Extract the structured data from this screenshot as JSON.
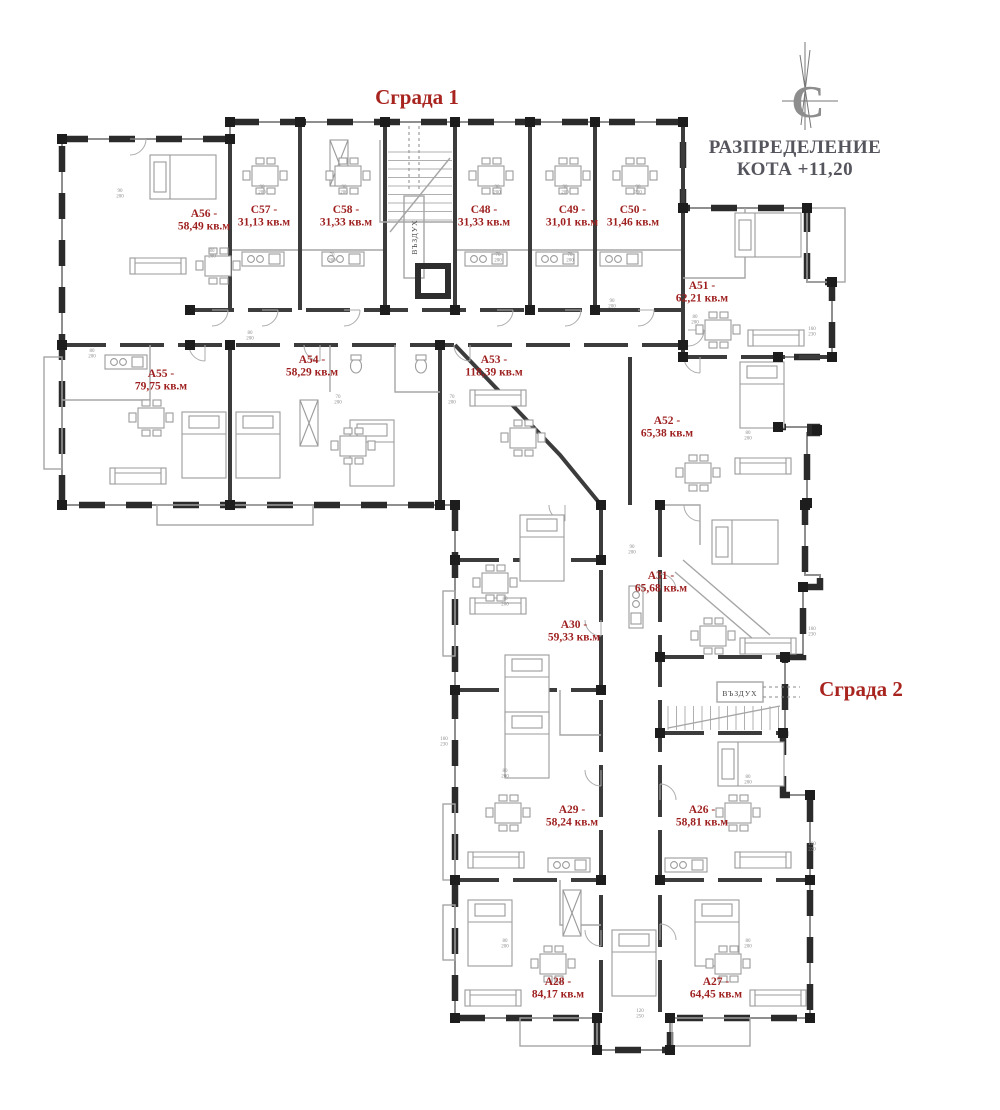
{
  "header": {
    "building1_title": "Сграда 1",
    "building2_title": "Сграда 2",
    "plan_title_line1": "РАЗПРЕДЕЛЕНИЕ",
    "plan_title_line2": "КОТА +11,20",
    "compass_letter": "С"
  },
  "stairwells": {
    "building1_air_shaft": "ВЪЗДУХ",
    "building2_air_shaft": "ВЪЗДУХ"
  },
  "colors": {
    "label_red": "#9e1f1f",
    "title_red": "#a8241f",
    "plan_title_gray": "#55555e",
    "wall_dark": "#2b2b2b",
    "wall_mid": "#8f8f8f",
    "furniture_gray": "#9b9b9b"
  },
  "apartments": [
    {
      "name": "А56 -",
      "area": "58,49 кв.м",
      "x": 204,
      "y": 217
    },
    {
      "name": "С57 -",
      "area": "31,13 кв.м",
      "x": 264,
      "y": 213
    },
    {
      "name": "С58 -",
      "area": "31,33 кв.м",
      "x": 346,
      "y": 213
    },
    {
      "name": "С48 -",
      "area": "31,33 кв.м",
      "x": 484,
      "y": 213
    },
    {
      "name": "С49 -",
      "area": "31,01 кв.м",
      "x": 572,
      "y": 213
    },
    {
      "name": "С50 -",
      "area": "31,46 кв.м",
      "x": 633,
      "y": 213
    },
    {
      "name": "А51 -",
      "area": "62,21 кв.м",
      "x": 702,
      "y": 289
    },
    {
      "name": "А55 -",
      "area": "79,75 кв.м",
      "x": 161,
      "y": 377
    },
    {
      "name": "А54 -",
      "area": "58,29 кв.м",
      "x": 312,
      "y": 363
    },
    {
      "name": "А53 -",
      "area": "118,39 кв.м",
      "x": 494,
      "y": 363
    },
    {
      "name": "А52 -",
      "area": "65,38 кв.м",
      "x": 667,
      "y": 424
    },
    {
      "name": "А31 -",
      "area": "65,68 кв.м",
      "x": 661,
      "y": 579
    },
    {
      "name": "А30 -",
      "area": "59,33 кв.м",
      "x": 574,
      "y": 628
    },
    {
      "name": "А29 -",
      "area": "58,24 кв.м",
      "x": 572,
      "y": 813
    },
    {
      "name": "А26 -",
      "area": "58,81 кв.м",
      "x": 702,
      "y": 813
    },
    {
      "name": "А28 -",
      "area": "84,17 кв.м",
      "x": 558,
      "y": 985
    },
    {
      "name": "А27 -",
      "area": "64,45 кв.м",
      "x": 716,
      "y": 985
    }
  ],
  "dimension_marks": [
    {
      "w": "90",
      "h": "200",
      "x": 120,
      "y": 192
    },
    {
      "w": "80",
      "h": "200",
      "x": 212,
      "y": 252
    },
    {
      "w": "90",
      "h": "200",
      "x": 262,
      "y": 188
    },
    {
      "w": "90",
      "h": "200",
      "x": 344,
      "y": 188
    },
    {
      "w": "70",
      "h": "200",
      "x": 332,
      "y": 256
    },
    {
      "w": "90",
      "h": "200",
      "x": 497,
      "y": 188
    },
    {
      "w": "90",
      "h": "200",
      "x": 565,
      "y": 188
    },
    {
      "w": "90",
      "h": "200",
      "x": 638,
      "y": 188
    },
    {
      "w": "70",
      "h": "200",
      "x": 498,
      "y": 256
    },
    {
      "w": "70",
      "h": "200",
      "x": 570,
      "y": 256
    },
    {
      "w": "80",
      "h": "200",
      "x": 92,
      "y": 352
    },
    {
      "w": "80",
      "h": "200",
      "x": 250,
      "y": 334
    },
    {
      "w": "70",
      "h": "200",
      "x": 338,
      "y": 398
    },
    {
      "w": "70",
      "h": "200",
      "x": 452,
      "y": 398
    },
    {
      "w": "90",
      "h": "200",
      "x": 612,
      "y": 302
    },
    {
      "w": "80",
      "h": "200",
      "x": 695,
      "y": 318
    },
    {
      "w": "80",
      "h": "200",
      "x": 748,
      "y": 434
    },
    {
      "w": "160",
      "h": "230",
      "x": 812,
      "y": 330
    },
    {
      "w": "80",
      "h": "200",
      "x": 505,
      "y": 600
    },
    {
      "w": "90",
      "h": "200",
      "x": 632,
      "y": 548
    },
    {
      "w": "160",
      "h": "230",
      "x": 812,
      "y": 630
    },
    {
      "w": "80",
      "h": "200",
      "x": 505,
      "y": 772
    },
    {
      "w": "80",
      "h": "200",
      "x": 748,
      "y": 778
    },
    {
      "w": "160",
      "h": "230",
      "x": 444,
      "y": 740
    },
    {
      "w": "80",
      "h": "200",
      "x": 505,
      "y": 942
    },
    {
      "w": "80",
      "h": "200",
      "x": 748,
      "y": 942
    },
    {
      "w": "120",
      "h": "250",
      "x": 640,
      "y": 1012
    },
    {
      "w": "160",
      "h": "220",
      "x": 812,
      "y": 845
    }
  ]
}
